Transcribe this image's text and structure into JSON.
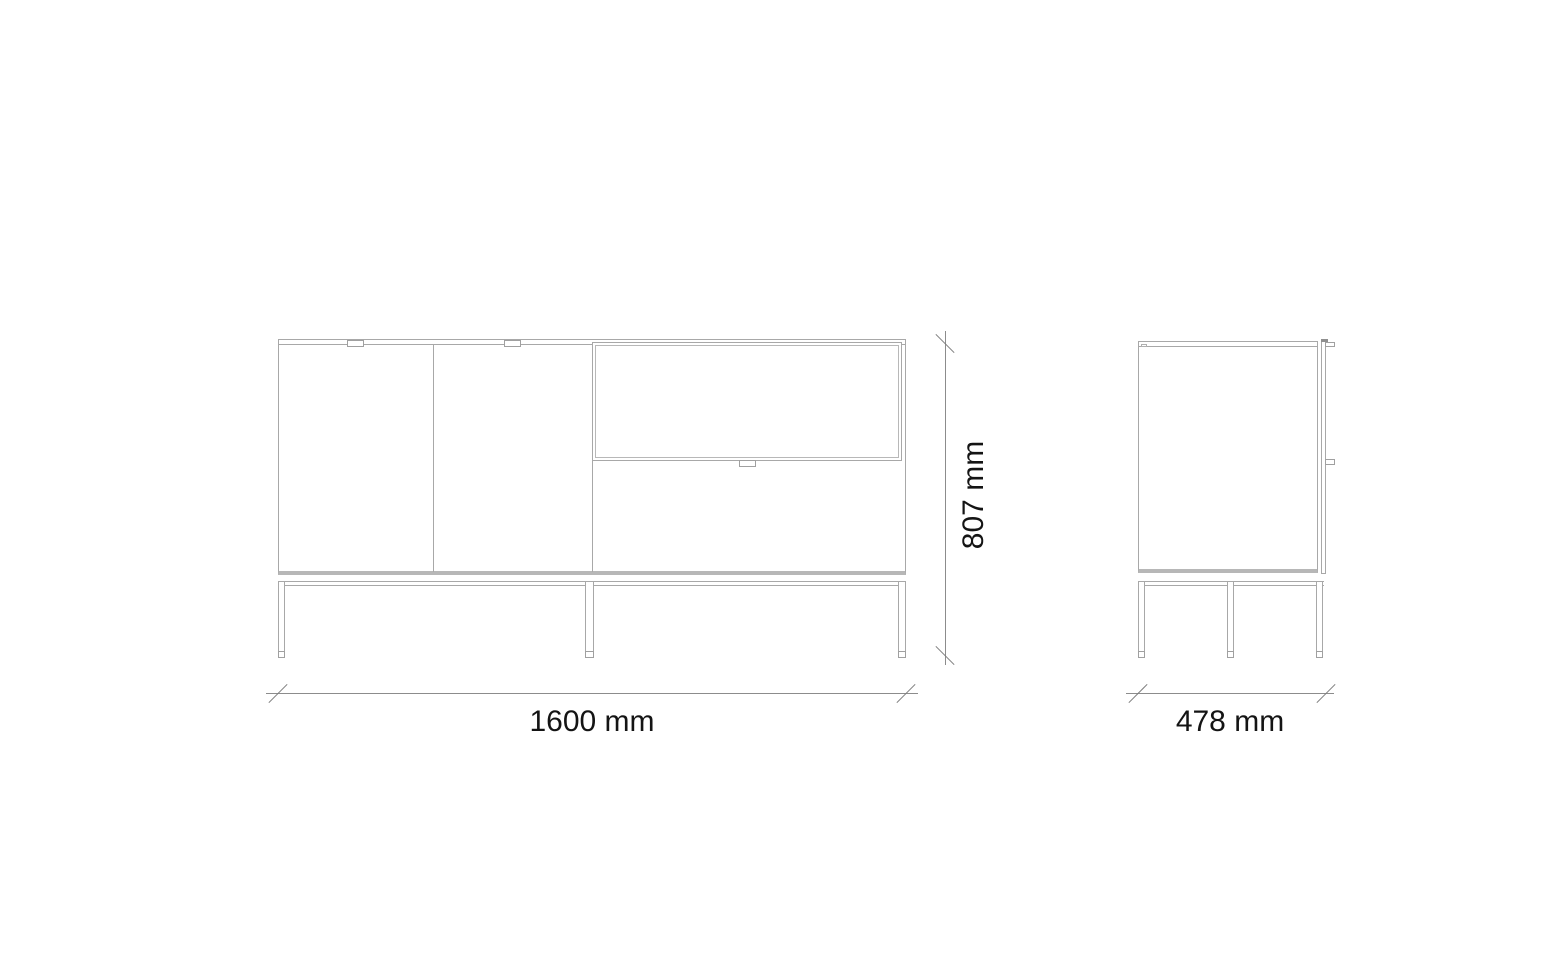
{
  "drawing": {
    "type": "furniture-dimensional-drawing",
    "subject": "sideboard with two doors, drop-down flap, drawer and metal leg frame",
    "background_color": "#ffffff",
    "outline_color": "#a8a8a8",
    "thick_edge_color": "#b7b7b7",
    "dimension_line_color": "#8c8c8c",
    "label_color": "#141414",
    "views": {
      "front": {
        "doors": 2,
        "flaps": 1,
        "drawers": 1,
        "legs": 3,
        "handles": 3
      },
      "side": {
        "legs": 3,
        "handles": 2
      }
    },
    "dimensions": {
      "width": {
        "label": "1600 mm",
        "value": 1600,
        "unit": "mm"
      },
      "height": {
        "label": "807 mm",
        "value": 807,
        "unit": "mm"
      },
      "depth": {
        "label": "478 mm",
        "value": 478,
        "unit": "mm"
      }
    }
  }
}
